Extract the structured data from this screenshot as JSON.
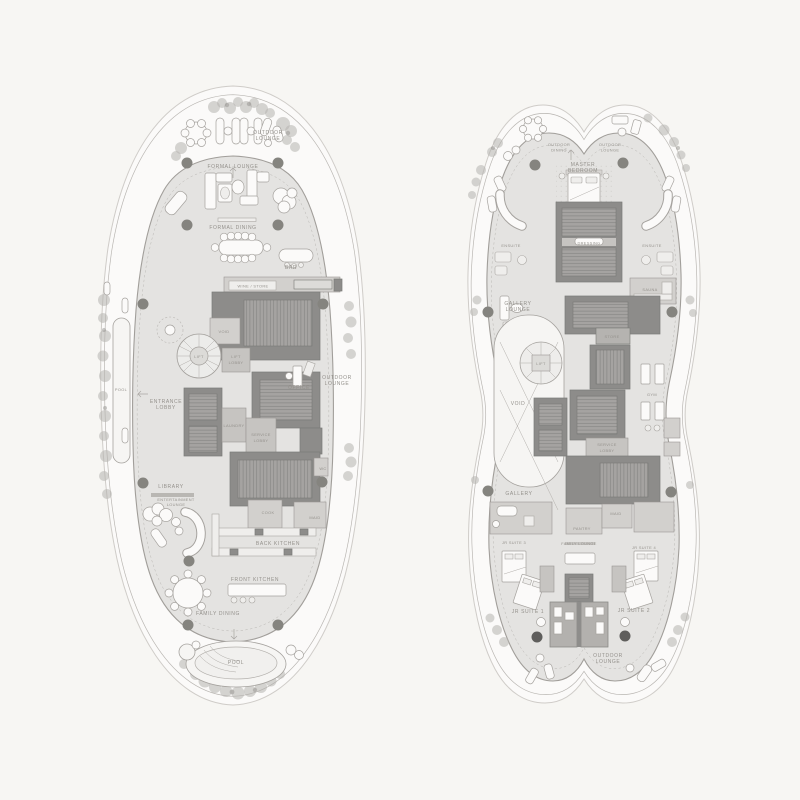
{
  "palette": {
    "background": "#f7f6f3",
    "deck": "#e4e3e1",
    "core": "#8d8c8a",
    "core_room": "#a5a3a1",
    "outline": "#a19e9a",
    "label": "#94918c",
    "furniture": "#fbfaf9",
    "pool": "#f6f5f3",
    "tree": "#b4b2ae"
  },
  "plans": [
    {
      "id": "floor-plan-left",
      "labels": [
        {
          "id": "outdoor-lounge-top",
          "lines": [
            "OUTDOOR",
            "LOUNGE"
          ]
        },
        {
          "id": "formal-lounge",
          "lines": [
            "FORMAL LOUNGE"
          ]
        },
        {
          "id": "formal-dining",
          "lines": [
            "FORMAL DINING"
          ]
        },
        {
          "id": "bar",
          "lines": [
            "BAR"
          ]
        },
        {
          "id": "wine-store",
          "lines": [
            "WINE / STORE"
          ]
        },
        {
          "id": "void",
          "lines": [
            "VOID"
          ]
        },
        {
          "id": "lift",
          "lines": [
            "LIFT"
          ]
        },
        {
          "id": "lift-lobby",
          "lines": [
            "LIFT",
            "LOBBY"
          ]
        },
        {
          "id": "entrance-lobby",
          "lines": [
            "ENTRANCE",
            "LOBBY"
          ]
        },
        {
          "id": "office",
          "lines": [
            "OFFICE"
          ]
        },
        {
          "id": "outdoor-lounge-right",
          "lines": [
            "OUTDOOR",
            "LOUNGE"
          ]
        },
        {
          "id": "laundry",
          "lines": [
            "LAUNDRY"
          ]
        },
        {
          "id": "service-lobby",
          "lines": [
            "SERVICE",
            "LOBBY"
          ]
        },
        {
          "id": "wc",
          "lines": [
            "WC"
          ]
        },
        {
          "id": "library",
          "lines": [
            "LIBRARY"
          ]
        },
        {
          "id": "entertainment-lounge",
          "lines": [
            "ENTERTAINMENT",
            "LOUNGE"
          ]
        },
        {
          "id": "cook",
          "lines": [
            "COOK"
          ]
        },
        {
          "id": "maid",
          "lines": [
            "MAID"
          ]
        },
        {
          "id": "back-kitchen",
          "lines": [
            "BACK KITCHEN"
          ]
        },
        {
          "id": "front-kitchen",
          "lines": [
            "FRONT KITCHEN"
          ]
        },
        {
          "id": "family-dining",
          "lines": [
            "FAMILY DINING"
          ]
        },
        {
          "id": "pool-main",
          "lines": [
            "POOL"
          ]
        },
        {
          "id": "pool-lap",
          "lines": [
            "POOL"
          ]
        }
      ]
    },
    {
      "id": "floor-plan-right",
      "labels": [
        {
          "id": "outdoor-dining",
          "lines": [
            "OUTDOOR",
            "DINING"
          ]
        },
        {
          "id": "outdoor-lounge-top",
          "lines": [
            "OUTDOOR",
            "LOUNGE"
          ]
        },
        {
          "id": "master-bedroom",
          "lines": [
            "MASTER",
            "BEDROOM"
          ]
        },
        {
          "id": "ensuite-left",
          "lines": [
            "ENSUITE"
          ]
        },
        {
          "id": "dressing",
          "lines": [
            "DRESSING"
          ]
        },
        {
          "id": "ensuite-right",
          "lines": [
            "ENSUITE"
          ]
        },
        {
          "id": "sauna",
          "lines": [
            "SAUNA"
          ]
        },
        {
          "id": "gallery-lounge",
          "lines": [
            "GALLERY",
            "LOUNGE"
          ]
        },
        {
          "id": "store",
          "lines": [
            "STORE"
          ]
        },
        {
          "id": "lift",
          "lines": [
            "LIFT"
          ]
        },
        {
          "id": "void",
          "lines": [
            "VOID"
          ]
        },
        {
          "id": "gym",
          "lines": [
            "GYM"
          ]
        },
        {
          "id": "service-lobby",
          "lines": [
            "SERVICE",
            "LOBBY"
          ]
        },
        {
          "id": "gallery",
          "lines": [
            "GALLERY"
          ]
        },
        {
          "id": "maid",
          "lines": [
            "MAID"
          ]
        },
        {
          "id": "pantry",
          "lines": [
            "PANTRY"
          ]
        },
        {
          "id": "family-lounge",
          "lines": [
            "FAMILY LOUNGE"
          ]
        },
        {
          "id": "jr-suite-3",
          "lines": [
            "JR SUITE 3"
          ]
        },
        {
          "id": "jr-suite-4",
          "lines": [
            "JR SUITE 4"
          ]
        },
        {
          "id": "jr-suite-1",
          "lines": [
            "JR SUITE 1"
          ]
        },
        {
          "id": "jr-suite-2",
          "lines": [
            "JR SUITE 2"
          ]
        },
        {
          "id": "outdoor-lounge-bottom",
          "lines": [
            "OUTDOOR",
            "LOUNGE"
          ]
        }
      ]
    }
  ]
}
